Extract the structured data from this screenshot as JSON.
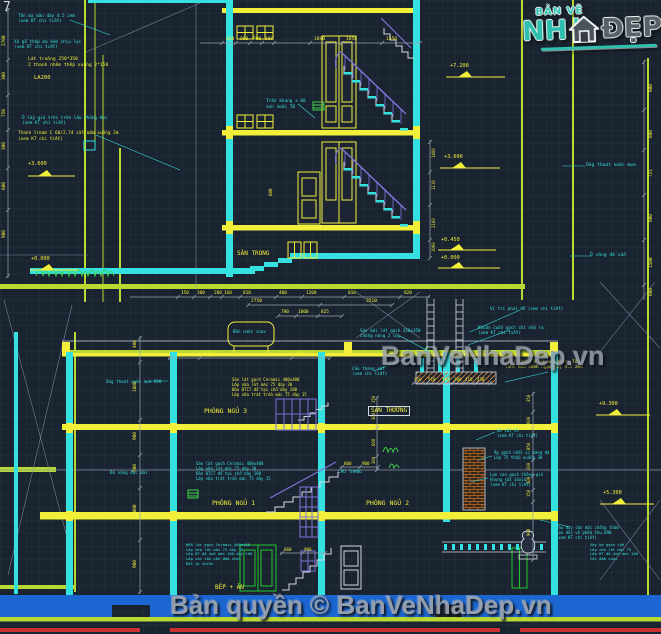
{
  "page": {
    "background": "#1a2330"
  },
  "colors": {
    "yellow": "#f1ef3a",
    "cyan": "#35e0e0",
    "white": "#d5dbe4",
    "green": "#3ed04a",
    "chartreuse": "#b9d832",
    "purple": "#7d74d8",
    "blue": "#1b66d0",
    "red": "#cc2f2f",
    "orange": "#c77a36",
    "gray": "#98a4b2"
  },
  "logo": {
    "tagline": "BẢN VẼ",
    "word_left": "NH",
    "word_right": "ĐẸP"
  },
  "watermarks": {
    "center": "BanVeNhaDep.vn",
    "footer": "Bản quyền © BanVeNhaDep.vn"
  },
  "annotations": [
    {
      "t": "7",
      "x": 3,
      "y": 0,
      "c": "w",
      "s": 13,
      "n": "grid-axis-label"
    },
    {
      "t": "Tôn mạ màu dày 4.5 zem\n(xem KT chi tiết)",
      "x": 18,
      "y": 14,
      "c": "c",
      "s": 4.3
    },
    {
      "t": "Xà gồ thép mạ kẽm chịu lực\n(xem KT chi tiết)",
      "x": 14,
      "y": 40,
      "c": "c",
      "s": 4.3
    },
    {
      "t": "Lát truờng 250*350\n2 thanh nhôm thếp xuống 2*150",
      "x": 28,
      "y": 57,
      "c": "y",
      "s": 4.6
    },
    {
      "t": "LA200",
      "x": 34,
      "y": 75,
      "c": "y",
      "s": 5.5,
      "n": "beam-label"
    },
    {
      "t": "Ô lấy gió trời trên lầu Phòng Hơi\n(xem KT chi tiết)",
      "x": 22,
      "y": 116,
      "c": "c",
      "s": 4.3
    },
    {
      "t": "Thanh lream C 60/2.74 sắt mâm xuống 2m\n(xem KT chi tiết)",
      "x": 18,
      "y": 131,
      "c": "y",
      "s": 4.4
    },
    {
      "t": "Trần khung x 60\nsơn nước TB",
      "x": 266,
      "y": 99,
      "c": "c",
      "s": 4.4
    },
    {
      "t": "SÂN TRONG",
      "x": 237,
      "y": 250,
      "c": "y",
      "s": 6,
      "n": "room-label-san-trong"
    },
    {
      "t": "Ống thoát nước mưa",
      "x": 586,
      "y": 163,
      "c": "c",
      "s": 4.6
    },
    {
      "t": "Ô văng đổ sẵn",
      "x": 590,
      "y": 253,
      "c": "c",
      "s": 4.6
    },
    {
      "t": "+3.600",
      "x": 28,
      "y": 161,
      "c": "y",
      "s": 5.2,
      "n": "level-marker-label"
    },
    {
      "t": "+0.000",
      "x": 31,
      "y": 256,
      "c": "y",
      "s": 5.2,
      "n": "level-marker-label"
    },
    {
      "t": "+7.200",
      "x": 450,
      "y": 63,
      "c": "y",
      "s": 5.2,
      "n": "level-marker-label"
    },
    {
      "t": "+3.600",
      "x": 444,
      "y": 154,
      "c": "y",
      "s": 5.2,
      "n": "level-marker-label"
    },
    {
      "t": "+0.450",
      "x": 441,
      "y": 237,
      "c": "y",
      "s": 5.2,
      "n": "level-marker-label"
    },
    {
      "t": "+0.000",
      "x": 441,
      "y": 255,
      "c": "y",
      "s": 5.2,
      "n": "level-marker-label"
    },
    {
      "t": "+9.300",
      "x": 599,
      "y": 401,
      "c": "y",
      "s": 5.2,
      "n": "level-marker-label"
    },
    {
      "t": "+5.300",
      "x": 603,
      "y": 490,
      "c": "y",
      "s": 5.2,
      "n": "level-marker-label"
    },
    {
      "t": "400",
      "x": 226,
      "y": 37,
      "s": 4.6
    },
    {
      "t": "900",
      "x": 240,
      "y": 37,
      "s": 4.6
    },
    {
      "t": "900",
      "x": 253,
      "y": 37,
      "s": 4.6
    },
    {
      "t": "300",
      "x": 265,
      "y": 37,
      "s": 4.6
    },
    {
      "t": "1890",
      "x": 314,
      "y": 37,
      "s": 4.6
    },
    {
      "t": "1850",
      "x": 346,
      "y": 37,
      "s": 4.6
    },
    {
      "t": "1350",
      "x": 386,
      "y": 37,
      "s": 4.6
    },
    {
      "t": "150",
      "x": 181,
      "y": 291,
      "s": 4.4
    },
    {
      "t": "300",
      "x": 197,
      "y": 291,
      "s": 4.4
    },
    {
      "t": "200",
      "x": 214,
      "y": 291,
      "s": 4.4
    },
    {
      "t": "160",
      "x": 224,
      "y": 291,
      "s": 4.4
    },
    {
      "t": "810",
      "x": 243,
      "y": 291,
      "s": 4.4
    },
    {
      "t": "400",
      "x": 279,
      "y": 291,
      "s": 4.4
    },
    {
      "t": "1200",
      "x": 306,
      "y": 291,
      "s": 4.4
    },
    {
      "t": "810",
      "x": 348,
      "y": 291,
      "s": 4.4
    },
    {
      "t": "820",
      "x": 404,
      "y": 291,
      "s": 4.4
    },
    {
      "t": "2750",
      "x": 251,
      "y": 299,
      "s": 4.6
    },
    {
      "t": "3510",
      "x": 366,
      "y": 299,
      "s": 4.6
    },
    {
      "t": "790",
      "x": 281,
      "y": 310,
      "s": 4.4
    },
    {
      "t": "1000",
      "x": 298,
      "y": 310,
      "s": 4.4
    },
    {
      "t": "825",
      "x": 321,
      "y": 310,
      "s": 4.4
    },
    {
      "t": "2360",
      "x": 202,
      "y": 352,
      "s": 4.6
    },
    {
      "t": "1350",
      "x": 295,
      "y": 352,
      "s": 4.6
    },
    {
      "t": "410",
      "x": 414,
      "y": 377,
      "s": 4.2
    },
    {
      "t": "510",
      "x": 428,
      "y": 377,
      "s": 4.2
    },
    {
      "t": "182",
      "x": 442,
      "y": 377,
      "s": 4.2
    },
    {
      "t": "300",
      "x": 454,
      "y": 377,
      "s": 4.2
    },
    {
      "t": "410",
      "x": 465,
      "y": 377,
      "s": 4.2
    },
    {
      "t": "430",
      "x": 477,
      "y": 377,
      "s": 4.2
    },
    {
      "t": "800",
      "x": 344,
      "y": 461,
      "s": 4.2
    },
    {
      "t": "900",
      "x": 362,
      "y": 461,
      "s": 4.2
    },
    {
      "t": "860",
      "x": 284,
      "y": 547,
      "s": 4.2
    },
    {
      "t": "900",
      "x": 304,
      "y": 547,
      "s": 4.2
    },
    {
      "t": "2700",
      "x": 2,
      "y": 46,
      "s": 4.4,
      "r": -90
    },
    {
      "t": "300",
      "x": 2,
      "y": 80,
      "s": 4.4,
      "r": -90
    },
    {
      "t": "750",
      "x": 2,
      "y": 117,
      "s": 4.4,
      "r": -90
    },
    {
      "t": "300",
      "x": 2,
      "y": 150,
      "s": 4.4,
      "r": -90
    },
    {
      "t": "600",
      "x": 2,
      "y": 190,
      "s": 4.4,
      "r": -90
    },
    {
      "t": "900",
      "x": 2,
      "y": 238,
      "s": 4.4,
      "r": -90
    },
    {
      "t": "900",
      "x": 649,
      "y": 92,
      "s": 4.4,
      "r": -90
    },
    {
      "t": "600",
      "x": 649,
      "y": 138,
      "s": 4.4,
      "r": -90
    },
    {
      "t": "721",
      "x": 649,
      "y": 177,
      "s": 4.4,
      "r": -90
    },
    {
      "t": "900",
      "x": 649,
      "y": 222,
      "s": 4.4,
      "r": -90
    },
    {
      "t": "1500",
      "x": 649,
      "y": 268,
      "s": 4.4,
      "r": -90
    },
    {
      "t": "600",
      "x": 649,
      "y": 296,
      "s": 4.4,
      "r": -90
    },
    {
      "t": "1400",
      "x": 431,
      "y": 158,
      "s": 4,
      "r": -90
    },
    {
      "t": "1110",
      "x": 431,
      "y": 190,
      "s": 4,
      "r": -90
    },
    {
      "t": "2160",
      "x": 431,
      "y": 228,
      "s": 4,
      "r": -90
    },
    {
      "t": "1060",
      "x": 431,
      "y": 252,
      "s": 4,
      "r": -90
    },
    {
      "t": "800",
      "x": 268,
      "y": 196,
      "s": 4.2,
      "r": -90
    },
    {
      "t": "400",
      "x": 133,
      "y": 348,
      "s": 4.4,
      "r": -90
    },
    {
      "t": "1800",
      "x": 133,
      "y": 392,
      "s": 4.4,
      "r": -90
    },
    {
      "t": "900",
      "x": 133,
      "y": 440,
      "s": 4.4,
      "r": -90
    },
    {
      "t": "500",
      "x": 133,
      "y": 472,
      "s": 4.4,
      "r": -90
    },
    {
      "t": "2000",
      "x": 133,
      "y": 515,
      "s": 4.4,
      "r": -90
    },
    {
      "t": "900",
      "x": 133,
      "y": 568,
      "s": 4.4,
      "r": -90
    },
    {
      "t": "350",
      "x": 526,
      "y": 402,
      "s": 4,
      "r": -90
    },
    {
      "t": "600",
      "x": 526,
      "y": 424,
      "s": 4,
      "r": -90
    },
    {
      "t": "850",
      "x": 526,
      "y": 450,
      "s": 4,
      "r": -90
    },
    {
      "t": "200",
      "x": 526,
      "y": 470,
      "s": 4,
      "r": -90
    },
    {
      "t": "300",
      "x": 526,
      "y": 484,
      "s": 4,
      "r": -90
    },
    {
      "t": "150",
      "x": 526,
      "y": 497,
      "s": 4,
      "r": -90
    },
    {
      "t": "900",
      "x": 526,
      "y": 536,
      "s": 4,
      "r": -90
    },
    {
      "t": "150",
      "x": 371,
      "y": 403,
      "s": 4,
      "r": -90
    },
    {
      "t": "300",
      "x": 371,
      "y": 420,
      "s": 4,
      "r": -90
    },
    {
      "t": "600",
      "x": 371,
      "y": 446,
      "s": 4,
      "r": -90
    },
    {
      "t": "300",
      "x": 371,
      "y": 464,
      "s": 4,
      "r": -90
    },
    {
      "t": "Bồn nước inox",
      "x": 233,
      "y": 329,
      "c": "c",
      "s": 4.2,
      "n": "water-tank-label"
    },
    {
      "t": "Sàn mái lát gạch 350x350\nchống nóng 2 lớp",
      "x": 360,
      "y": 328,
      "c": "c",
      "s": 4.2
    },
    {
      "t": "Vị trí phơi đồ (xem chi tiết)",
      "x": 490,
      "y": 306,
      "c": "c",
      "s": 4.2
    },
    {
      "t": "Khuôn cuốn gạch chỉ nhô ra\n(xem KT chi tiết)",
      "x": 478,
      "y": 325,
      "c": "c",
      "s": 4.2
    },
    {
      "t": "Trần khung X.60 sơn nước, Tôn\nlạnh màu xanh ngọc dày 4.5 zem",
      "x": 505,
      "y": 360,
      "c": "y",
      "s": 4.3
    },
    {
      "t": "SÂN THƯỜNG",
      "x": 368,
      "y": 406,
      "c": "y",
      "s": 6,
      "b": true,
      "n": "room-label-san-thuong"
    },
    {
      "t": "Cầu thang sắt\n(xem chi tiết)",
      "x": 352,
      "y": 366,
      "c": "c",
      "s": 4.2
    },
    {
      "t": "CẦU THANG",
      "x": 338,
      "y": 470,
      "c": "c",
      "s": 4.4
    },
    {
      "t": "Sàn lát gạch Ceramic 400x400\nLớp vữa lót mác 75 dày 30\nBản BTCT đổ tại chỗ dày 100\nLớp vữa trát trần mác 75 dày 15",
      "x": 232,
      "y": 377,
      "c": "y",
      "s": 4
    },
    {
      "t": "PHÒNG NGỦ 3",
      "x": 204,
      "y": 407,
      "c": "y",
      "s": 6.5,
      "n": "room-label-phong-ngu-3"
    },
    {
      "t": "Sàn lát gạch Ceramic 400x400\nLớp vữa lót mác 75 dày 30\nBản BTCT đổ tại chỗ dày 100\nLớp vữa trát trần mác 75 dày 15",
      "x": 196,
      "y": 461,
      "c": "c",
      "s": 4
    },
    {
      "t": "PHÒNG NGỦ 1",
      "x": 212,
      "y": 499,
      "c": "y",
      "s": 6.5,
      "n": "room-label-phong-ngu-1"
    },
    {
      "t": "PHÒNG NGỦ 2",
      "x": 366,
      "y": 499,
      "c": "y",
      "s": 6.5,
      "n": "room-label-phong-ngu-2"
    },
    {
      "t": "BẾP + ĂN",
      "x": 215,
      "y": 584,
      "c": "y",
      "s": 6,
      "n": "room-label-bep-an"
    },
    {
      "t": "Nền lát gạch Ceramic 400x400\nLớp vữa lót mác 75 dày 30\nLớp BT đá 4x6 mác 100 dày 100\nLớp cát tôn nền đầm chặt\nĐất tự nhiên",
      "x": 186,
      "y": 543,
      "c": "c",
      "s": 3.8
    },
    {
      "t": "Xây bó gạch thẻ\nLớp vữa lót mác 75\nLớp BT đá 4x6 mác 100\nCát đầm chặt",
      "x": 590,
      "y": 543,
      "c": "c",
      "s": 3.8
    },
    {
      "t": "Kẽ sắt V5\n(xem KT chi tiết)",
      "x": 497,
      "y": 428,
      "c": "c",
      "s": 4
    },
    {
      "t": "Áp gạch nhồi xi măng đá\nLớp 75 thếp xuống 30",
      "x": 494,
      "y": 450,
      "c": "c",
      "s": 4
    },
    {
      "t": "Lan can gạch thông gió\nkhung sắt 14x14\n(xem KT chi tiết)",
      "x": 490,
      "y": 472,
      "c": "c",
      "s": 4
    },
    {
      "t": "Thu đáy sàn mái chống thấm\ntạo dốc về phễu thu D90\n(xem KT chi tiết)",
      "x": 556,
      "y": 525,
      "c": "c",
      "s": 4
    },
    {
      "t": "Ống thoát nước mưa D90",
      "x": 106,
      "y": 379,
      "c": "c",
      "s": 4.2
    },
    {
      "t": "Đá vàng đục mài",
      "x": 110,
      "y": 470,
      "c": "c",
      "s": 4.2
    }
  ]
}
